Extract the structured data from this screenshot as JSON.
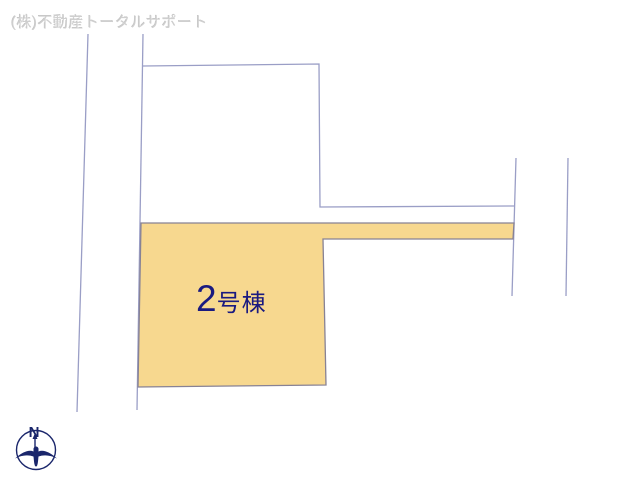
{
  "watermark": {
    "company": "(株)不動産トータルサポート"
  },
  "site_plan": {
    "lot_label": {
      "number": "2",
      "suffix": "号棟",
      "full": "2号棟"
    },
    "compass": {
      "north_label": "N"
    },
    "colors": {
      "highlighted_lot_fill": "#F7D88F",
      "highlighted_lot_border": "#878295",
      "boundary_line": "#9A9EC6",
      "lot_label_text": "#1A1A80",
      "compass_navy": "#1A266B",
      "watermark_text": "#CFCFCF",
      "background": "#FFFFFF"
    }
  }
}
